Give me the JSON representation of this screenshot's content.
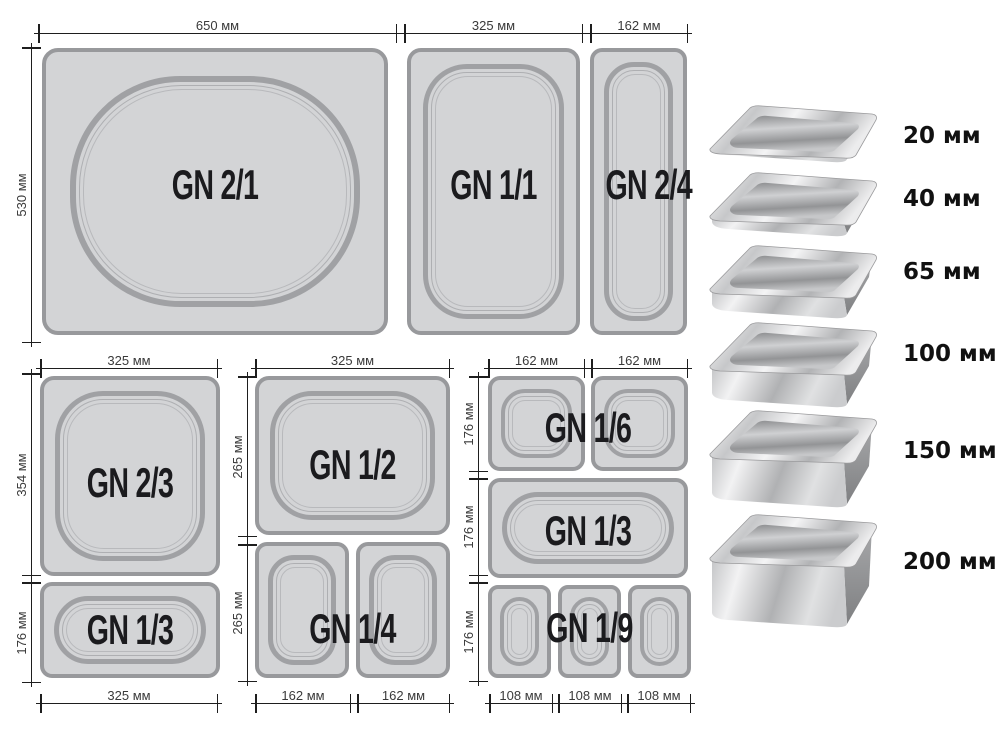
{
  "diagram": {
    "top_row": {
      "width_labels": [
        "650 мм",
        "325 мм",
        "162 мм"
      ],
      "height_label": "530 мм",
      "pans": [
        {
          "label": "GN 2/1"
        },
        {
          "label": "GN 1/1"
        },
        {
          "label": "GN 2/4"
        }
      ]
    },
    "left_group": {
      "top_width_label": "325 мм",
      "height_labels": [
        "354 мм",
        "176 мм"
      ],
      "bottom_width_label": "325 мм",
      "pans": [
        {
          "label": "GN 2/3"
        },
        {
          "label": "GN 1/3"
        }
      ]
    },
    "middle_group": {
      "top_width_label": "325 мм",
      "height_labels": [
        "265 мм",
        "265 мм"
      ],
      "bottom_width_labels": [
        "162 мм",
        "162 мм"
      ],
      "pans": [
        {
          "label": "GN 1/2"
        },
        {
          "label": "GN 1/4"
        }
      ]
    },
    "right_group": {
      "top_width_labels": [
        "162 мм",
        "162 мм"
      ],
      "height_labels": [
        "176 мм",
        "176 мм",
        "176 мм"
      ],
      "bottom_width_labels": [
        "108 мм",
        "108 мм",
        "108 мм"
      ],
      "pans": [
        {
          "label": "GN 1/6"
        },
        {
          "label": "GN 1/3"
        },
        {
          "label": "GN 1/9"
        }
      ]
    }
  },
  "depth_photos": {
    "items": [
      {
        "depth_label": "20 мм"
      },
      {
        "depth_label": "40 мм"
      },
      {
        "depth_label": "65 мм"
      },
      {
        "depth_label": "100 мм"
      },
      {
        "depth_label": "150 мм"
      },
      {
        "depth_label": "200 мм"
      }
    ]
  },
  "colors": {
    "pan_fill": "#d3d4d6",
    "pan_border": "#98999c",
    "dimension_line": "#1e1e1e",
    "label_text": "#1b1b1e"
  }
}
